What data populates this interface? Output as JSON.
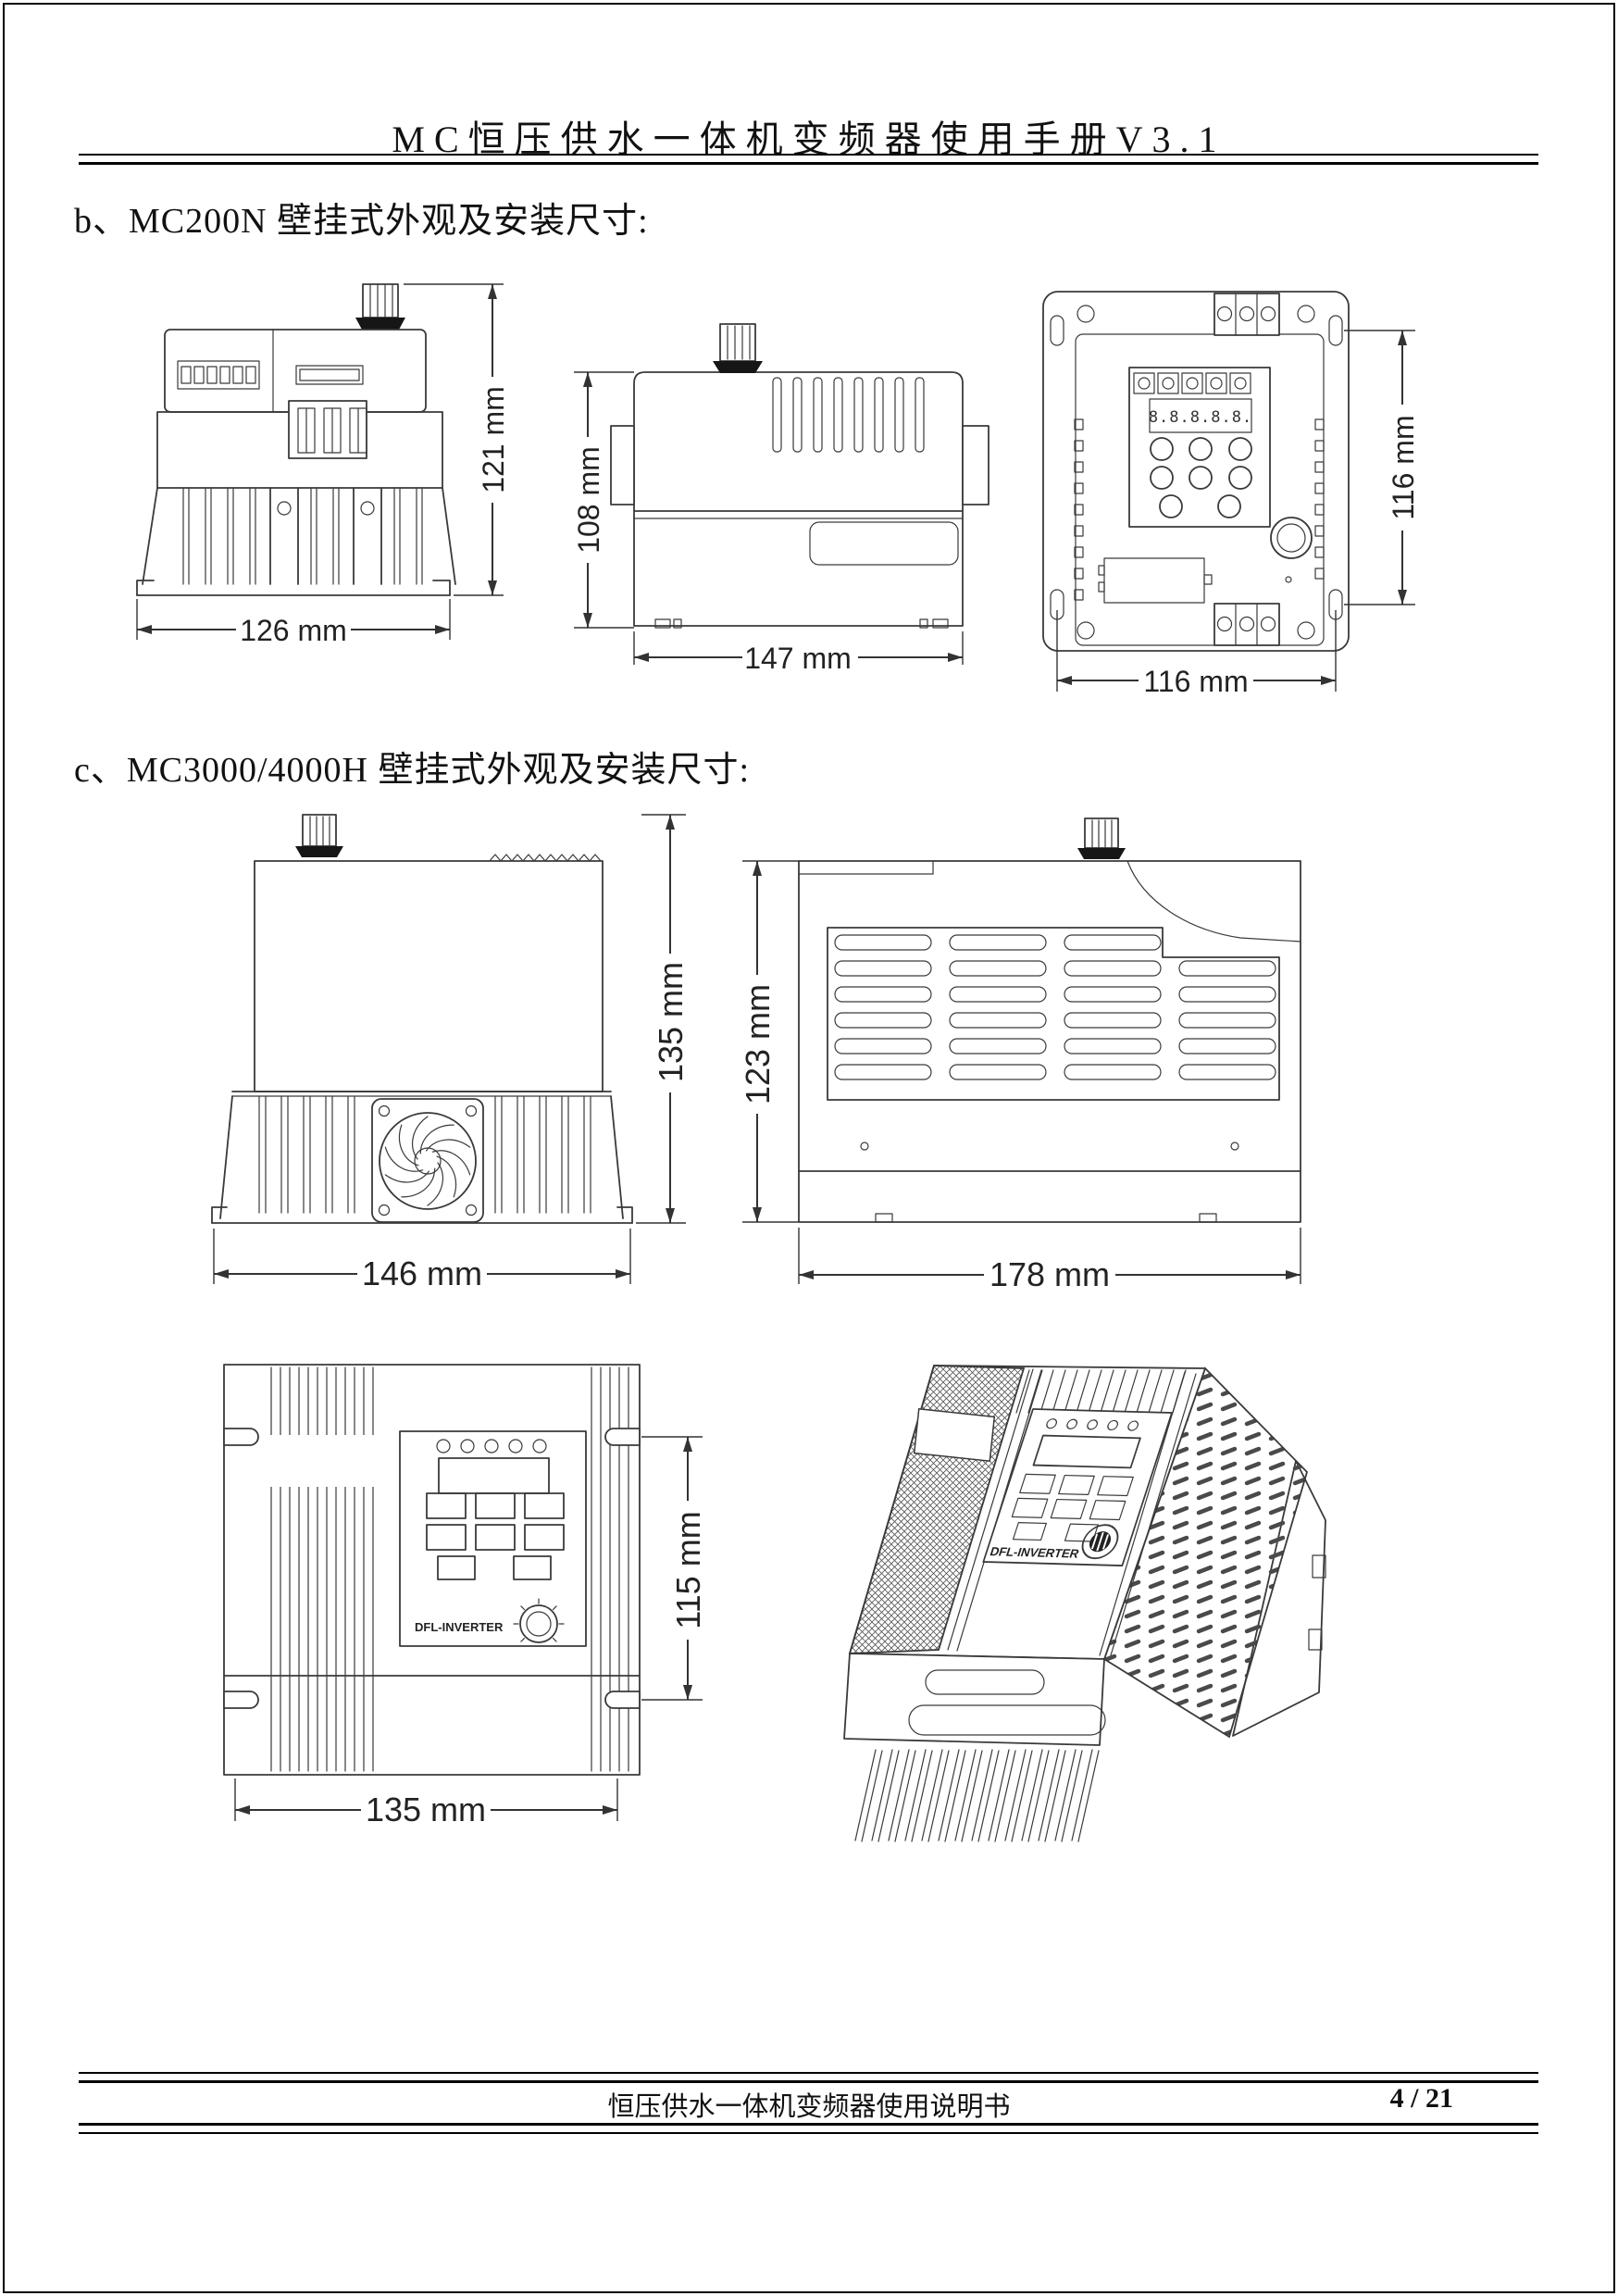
{
  "page": {
    "header": {
      "title": "MC恒压供水一体机变频器使用手册V3.1"
    },
    "sections": {
      "b": {
        "title": "b、MC200N 壁挂式外观及安装尺寸:"
      },
      "c": {
        "title": "c、MC3000/4000H 壁挂式外观及安装尺寸:"
      }
    },
    "footer": {
      "doc_title": "恒压供水一体机变频器使用说明书",
      "page_number": "4 / 21"
    }
  },
  "theme": {
    "paper": "#ffffff",
    "ink": "#1a1a1a",
    "line_color": "#3a3a3a",
    "dim_color": "#333333"
  },
  "drawings": {
    "mc200n_front": {
      "height_label": "121 mm",
      "width_label": "126 mm"
    },
    "mc200n_side": {
      "height_label": "108 mm",
      "width_label": "147 mm"
    },
    "mc200n_back": {
      "height_label": "116 mm",
      "width_label": "116 mm",
      "display_text": "8.8.8.8.8."
    },
    "mc3000_front": {
      "height_label": "135 mm",
      "width_label": "146 mm"
    },
    "mc3000_side": {
      "height_label": "123 mm",
      "width_label": "178 mm"
    },
    "mc3000_panel": {
      "height_label": "115 mm",
      "width_label": "135 mm",
      "brand": "DFL-INVERTER"
    },
    "mc3000_3d": {
      "brand": "DFL-INVERTER"
    }
  }
}
